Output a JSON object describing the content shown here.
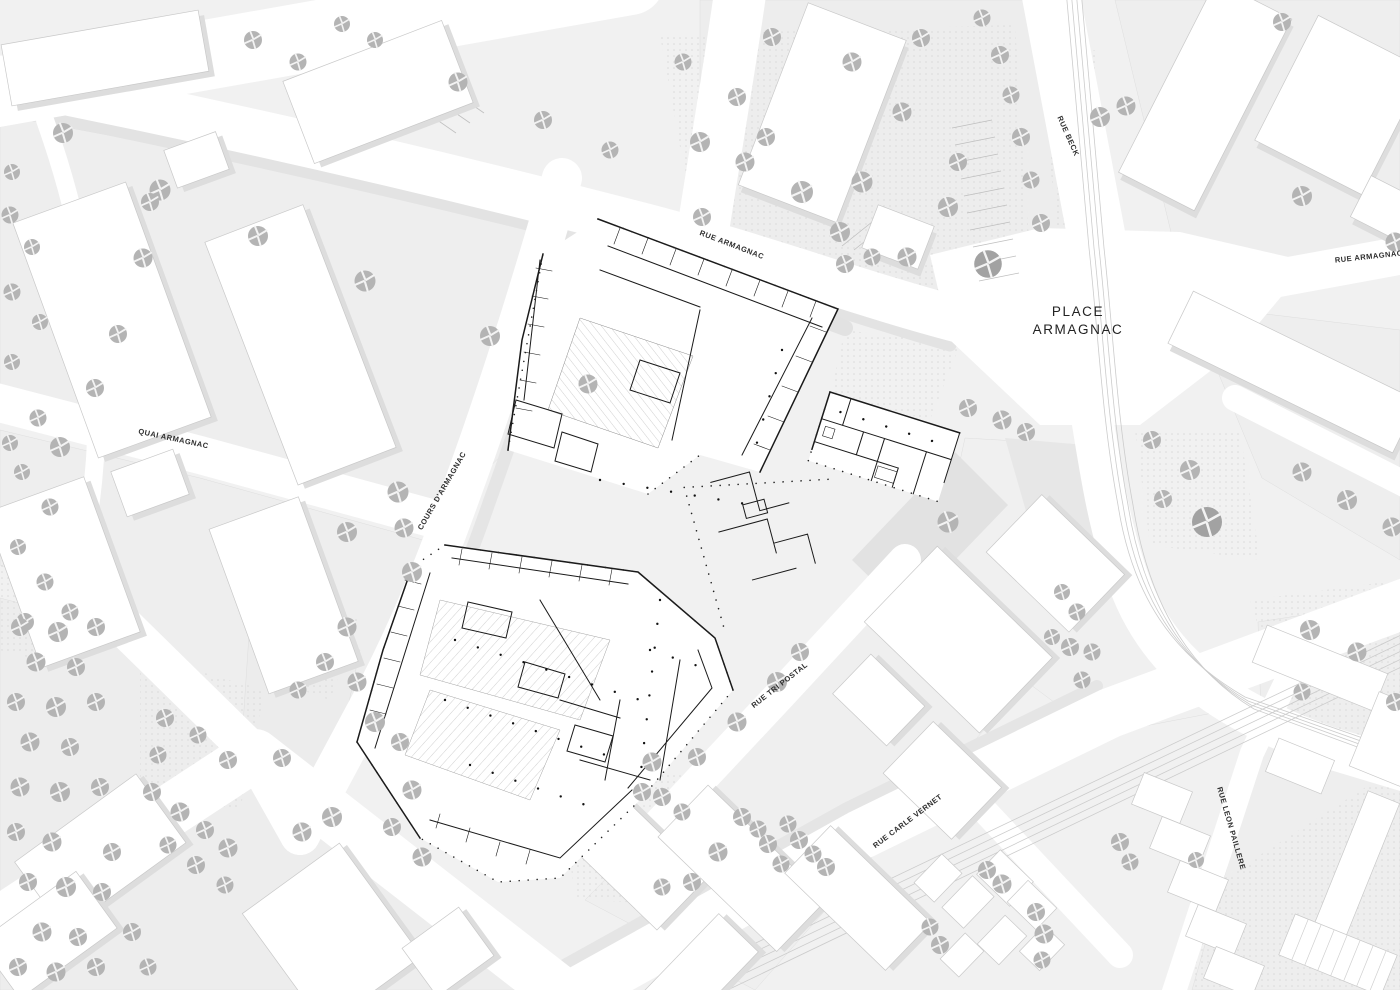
{
  "map": {
    "type": "architectural-site-plan",
    "place": {
      "line1": "PLACE",
      "line2": "ARMAGNAC"
    },
    "streets": [
      {
        "label": "RUE BECK"
      },
      {
        "label": "RUE ARMAGNAC"
      },
      {
        "label": "RUE ARMAGNAC"
      },
      {
        "label": "QUAI ARMAGNAC"
      },
      {
        "label": "COURS D'ARMAGNAC"
      },
      {
        "label": "RUE TRI POSTAL"
      },
      {
        "label": "RUE CARLE VERNET"
      },
      {
        "label": "RUE LEON PAILLERE"
      }
    ]
  },
  "colors": {
    "background": "#f1f1f1",
    "street": "#ffffff",
    "building": "#ffffff",
    "building_stroke": "#c9c9c9",
    "shadow": "#dddddd",
    "tree": "#b4b4b4",
    "tree_dark": "#a2a2a2",
    "plan_line": "#1a1a1a",
    "label": "#2e2e2e",
    "stipple": "#d2d2d2",
    "track": "#cccccc"
  }
}
